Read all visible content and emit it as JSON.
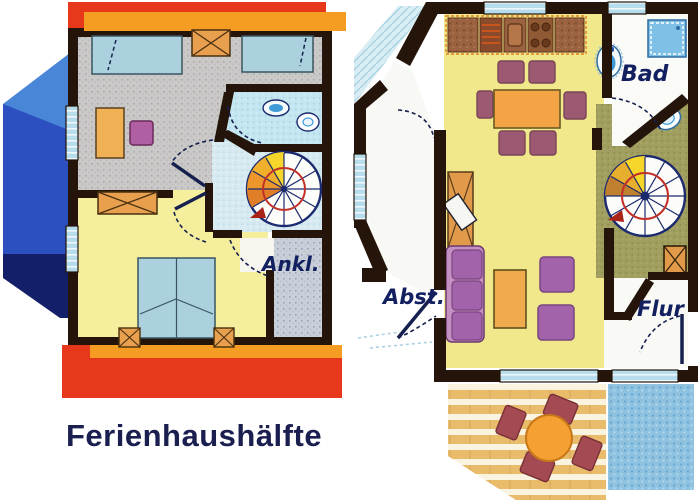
{
  "caption": "Ferienhaushälfte",
  "floor_plans": {
    "upper_floor": {
      "name": "upper floor plan",
      "labels": {
        "dressing_room": "Ankl."
      }
    },
    "ground_floor": {
      "name": "ground floor plan",
      "labels": {
        "bathroom": "Bad",
        "storage": "Abst.",
        "hallway": "Flur"
      }
    }
  },
  "palette": {
    "wall": "#241409",
    "roof_red": "#e8381c",
    "roof_orange": "#f59d22",
    "gable_blue_light": "#4a86d8",
    "gable_blue": "#2d50c0",
    "gable_blue_dark": "#141f6a",
    "floor_yellow": "#f3ec94",
    "floor_gray": "#cac9c7",
    "floor_bath_blue": "#c4e6f0",
    "floor_bluegray": "#c9cfd9",
    "landing_olive": "#a19f60",
    "bed_blue": "#abd0de",
    "furniture_orange": "#e8a04e",
    "furniture_purple": "#a263aa",
    "dining_chair_mauve": "#9c5a72",
    "terrace_chair_red": "#a34a52",
    "stair_yellow": "#f6d62a",
    "stair_orange": "#ed962c",
    "spiral_rail_red": "#c23028",
    "deck_tan": "#eabc6c",
    "terrain_blue": "#8ec2e0",
    "label_navy": "#122060"
  }
}
